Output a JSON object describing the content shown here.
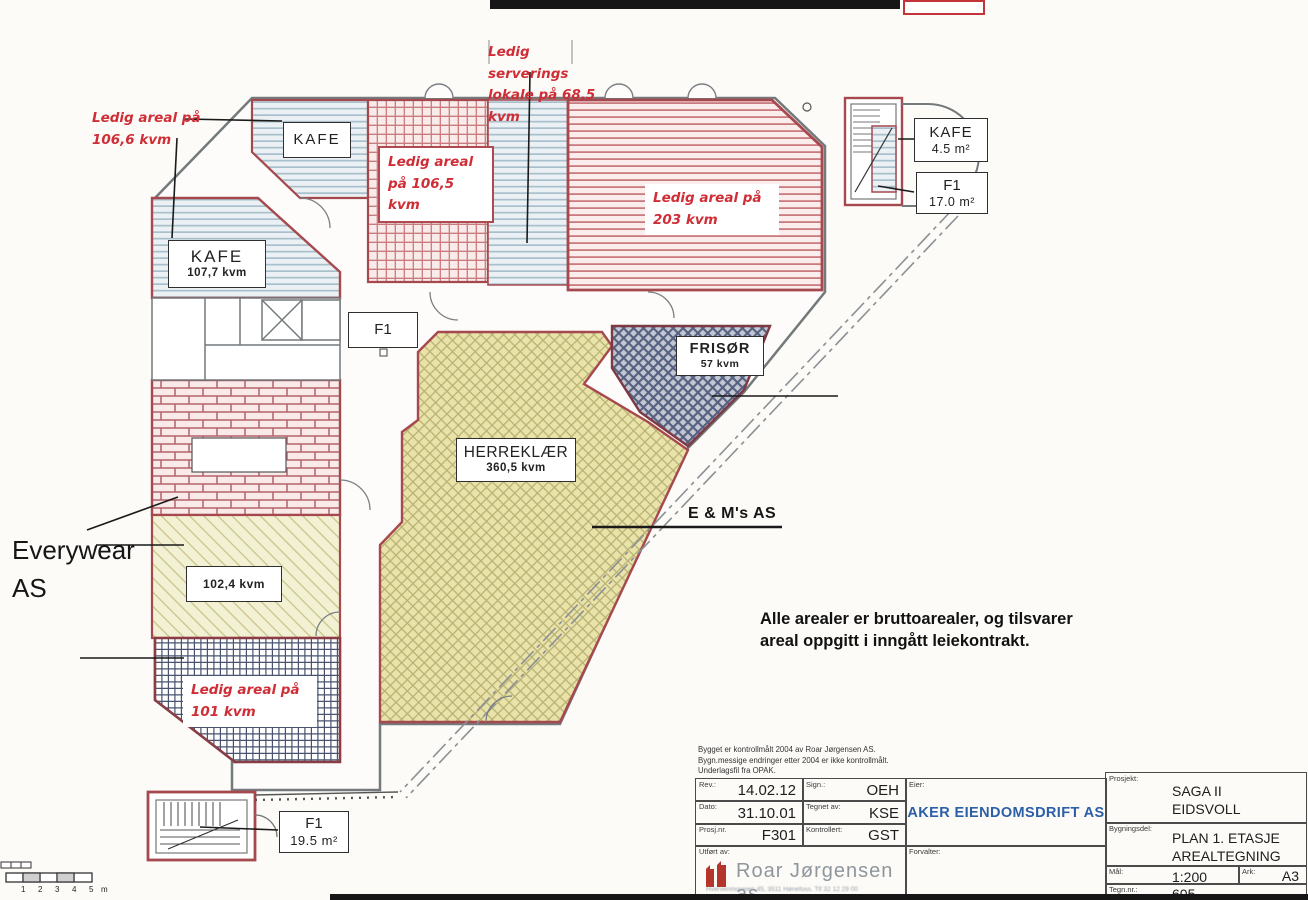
{
  "drawing": {
    "red_notes": {
      "serving": "Ledig serverings\nlokale på 68,5\nkvm",
      "areal_106_6": "Ledig areal på\n106,6 kvm",
      "areal_106_5": "Ledig areal\npå 106,5 kvm",
      "areal_203": "Ledig areal på\n203 kvm",
      "areal_101": "Ledig areal på\n101 kvm"
    },
    "rooms": {
      "kafe_top": "KAFE",
      "kafe_left": {
        "name": "KAFE",
        "area": "107,7 kvm"
      },
      "kafe_small": {
        "name": "KAFE",
        "area": "4.5 m²"
      },
      "f1_small": {
        "name": "F1",
        "area": "17.0 m²"
      },
      "f1_mid": "F1",
      "frisor": {
        "name": "FRISØR",
        "area": "57 kvm"
      },
      "herreklaer": {
        "name": "HERREKLÆR",
        "area": "360,5 kvm"
      },
      "everywear_area": "102,4 kvm",
      "f1_bottom": {
        "name": "F1",
        "area": "19.5 m²"
      }
    },
    "tenants": {
      "everywear": "Everywear\nAS",
      "em_as": "E & M's AS"
    },
    "note": "Alle arealer er bruttoarealer, og tilsvarer\nareal oppgitt i inngått leiekontrakt.",
    "scale_bar": {
      "labels": [
        "1",
        "2",
        "3",
        "4",
        "5",
        "m"
      ]
    }
  },
  "titleblock": {
    "disclaimer": "Bygget er kontrollmålt 2004 av Roar Jørgensen AS.\nBygn.messige endringer etter 2004 er ikke kontrollmålt.\nUnderlagsfil fra OPAK.",
    "rev_label": "Rev.:",
    "rev": "14.02.12",
    "sign_label": "Sign.:",
    "sign": "OEH",
    "dato_label": "Dato:",
    "dato": "31.10.01",
    "tegnet_label": "Tegnet av:",
    "tegnet": "KSE",
    "prosjnr_label": "Prosj.nr.",
    "prosjnr": "F301",
    "kontrollert_label": "Kontrollert:",
    "kontrollert": "GST",
    "eier_label": "Eier:",
    "eier": "AKER EIENDOMSDRIFT AS",
    "utfort_label": "Utført av:",
    "firm": "Roar Jørgensen as",
    "firm_address": "Hvervenmoveien 45, 3511 Hønefoss. Tlf 32 12 29 00",
    "forvalter_label": "Forvalter:",
    "prosjekt_label": "Prosjekt:",
    "prosjekt": "SAGA II\nEIDSVOLL",
    "bygningsdel_label": "Bygningsdel:",
    "bygningsdel": "PLAN 1. ETASJE\nAREALTEGNING",
    "maal_label": "Mål:",
    "maal": "1:200",
    "ark_label": "Ark:",
    "ark": "A3",
    "tegnnr_label": "Tegn.nr.:",
    "tegnnr": "605"
  },
  "colors": {
    "red_note": "#cf2e36",
    "leased_border": "#a6494f",
    "brand_blue": "#2b5fa8",
    "logo_red": "#b5342c",
    "yellow_area": "#e9e2a9",
    "blue_area": "#eaf0f3"
  }
}
